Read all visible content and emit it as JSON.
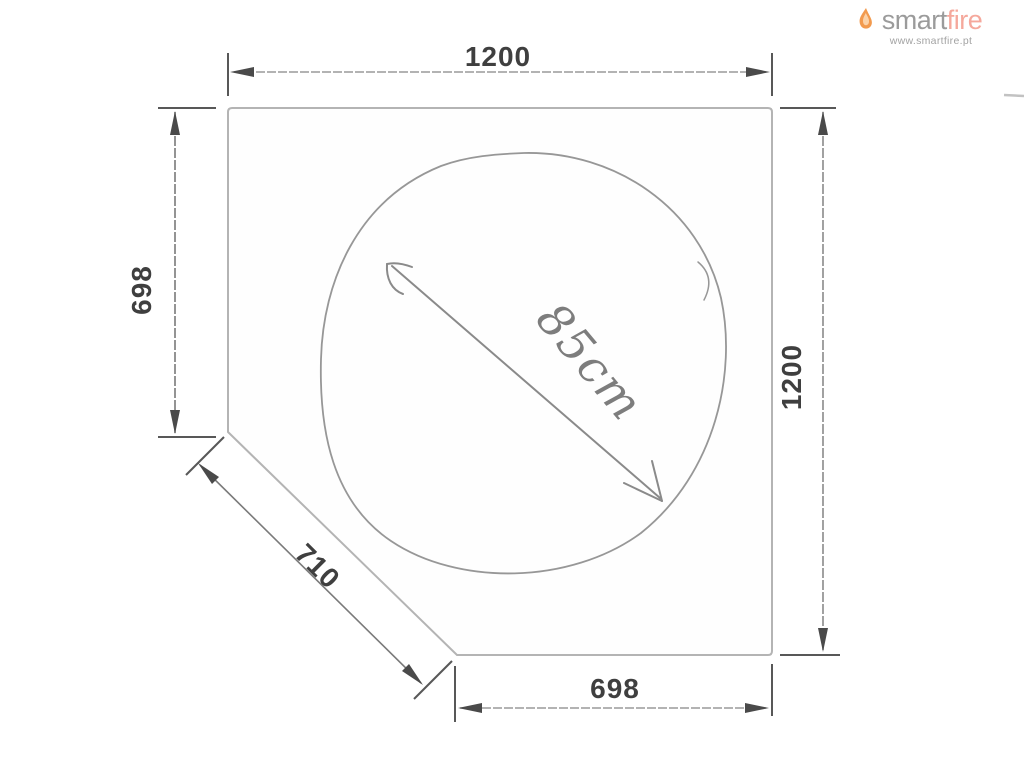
{
  "canvas": {
    "width": 1024,
    "height": 768,
    "background": "#ffffff"
  },
  "logo": {
    "brand_part1": "smart",
    "brand_part2": "fire",
    "website": "www.smartfire.pt",
    "colors": {
      "part1": "#9b9b9b",
      "part2": "#f5a89c",
      "flame": "#f29a4e",
      "website": "#a3a3a3"
    }
  },
  "drawing": {
    "shape": "corner-pentagon-panel",
    "line_colors": {
      "outline": "#b2b2b2",
      "dimension_line": "#9a9a9a",
      "marks": "#4f4f4f",
      "sketch": "#8f8f8f"
    },
    "dimensions": [
      {
        "id": "top-width",
        "label": "1200",
        "orientation": "horizontal"
      },
      {
        "id": "left-height",
        "label": "698",
        "orientation": "vertical"
      },
      {
        "id": "right-height",
        "label": "1200",
        "orientation": "vertical"
      },
      {
        "id": "bottom-width",
        "label": "698",
        "orientation": "horizontal"
      },
      {
        "id": "diagonal-edge",
        "label": "710",
        "orientation": "diagonal-45"
      }
    ],
    "annotation": {
      "label": "85cm",
      "style": "handwritten-circle-diameter"
    }
  }
}
